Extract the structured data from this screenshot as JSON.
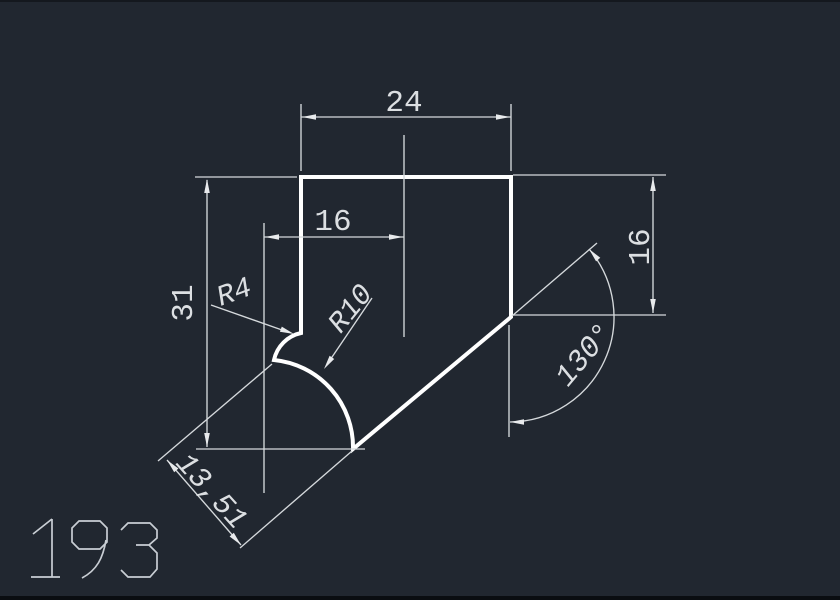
{
  "canvas": {
    "background": "#212730",
    "edge_strip_top_color": "#14181e",
    "edge_strip_bottom_color": "#0a0d11",
    "outline_color": "#ffffff",
    "dim_line_color": "#d5d9dc",
    "dim_text_color": "#dcdfe2",
    "part_number_color": "#c9ced4"
  },
  "dimensions": {
    "width_top": "24",
    "width_inner": "16",
    "height_left": "31",
    "height_right": "16",
    "angle": "130°",
    "aligned": "13,51",
    "fillet_radius": "R4",
    "arc_radius": "R10"
  },
  "part_number": "193"
}
